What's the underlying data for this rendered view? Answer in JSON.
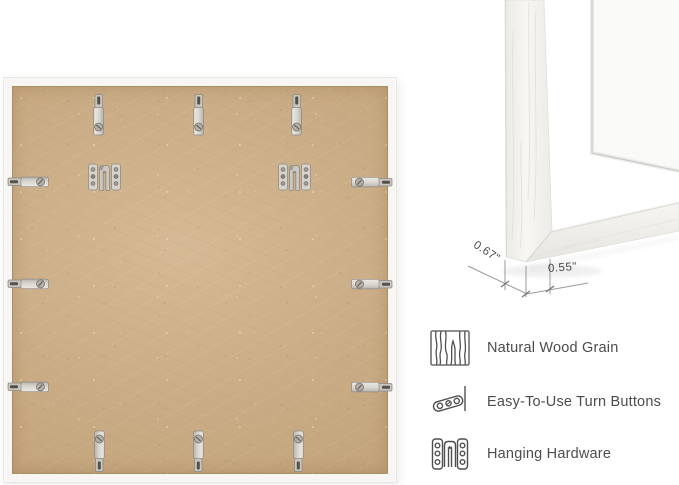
{
  "product_views": {
    "back_view": {
      "description": "frame back with MDF board and mounted hardware",
      "board_color": "#c9ac85",
      "frame_color": "#f7f6f3",
      "turn_button_count": 12,
      "hanging_bracket_count": 2
    },
    "corner_view": {
      "description": "white frame corner with mat",
      "dim_face": "0.67\"",
      "dim_depth": "0.55\""
    }
  },
  "features": [
    {
      "icon": "wood-grain-icon",
      "label": "Natural Wood Grain"
    },
    {
      "icon": "turn-button-icon",
      "label": "Easy-To-Use Turn Buttons"
    },
    {
      "icon": "hanging-hardware-icon",
      "label": "Hanging Hardware"
    }
  ],
  "colors": {
    "metal": "#c9c5bf",
    "annotation_line": "#8f8f8f",
    "feature_text": "#4c4c4c"
  }
}
